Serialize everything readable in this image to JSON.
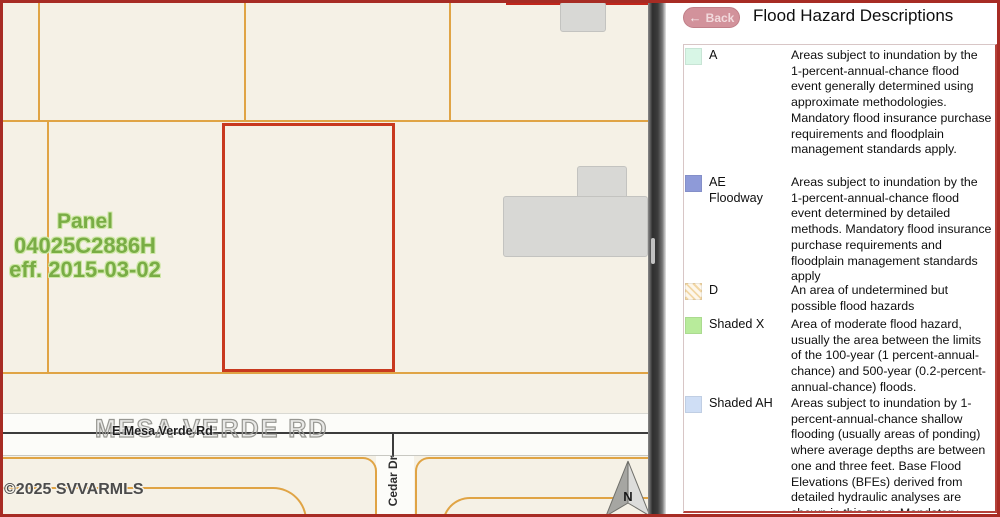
{
  "map": {
    "panel_label": {
      "line1": "Panel",
      "line2": "04025C2886H",
      "line3": "eff. 2015-03-02"
    },
    "roads": {
      "main_outline": "MESA VERDE RD",
      "main": "E Mesa Verde Rd",
      "cross": "Cedar Dr"
    },
    "copyright": "©2025 SVVARMLS",
    "north_label": "N",
    "colors": {
      "background": "#f5f1e6",
      "parcel_line": "#e0a445",
      "selected_parcel_outline": "#c8391f",
      "building_fill": "#d8d8d5",
      "panel_label_green": "#79ad45",
      "road_fill": "#fcfcf9"
    }
  },
  "panel": {
    "back_label": "Back",
    "back_arrow": "←",
    "title": "Flood Hazard Descriptions",
    "legend": [
      {
        "code": "A",
        "swatch": "solid",
        "color": "#d8f6e6",
        "description": "Areas subject to inundation by the 1-percent-annual-chance flood event generally determined using approximate methodologies. Mandatory flood insurance purchase requirements and floodplain management standards apply."
      },
      {
        "code": "AE\nFloodway",
        "swatch": "solid",
        "color": "#8e9ad8",
        "description": "Areas subject to inundation by the 1-percent-annual-chance flood event determined by detailed methods. Mandatory flood insurance purchase requirements and floodplain management standards apply"
      },
      {
        "code": "D",
        "swatch": "hatch",
        "color": "#f2d7a6",
        "description": "An area of undetermined but possible flood hazards"
      },
      {
        "code": "Shaded X",
        "swatch": "solid",
        "color": "#b8eb9b",
        "description": "Area of moderate flood hazard, usually the area between the limits of the 100-year (1 percent-annual-chance) and 500-year (0.2-percent-annual-chance) floods."
      },
      {
        "code": "Shaded AH",
        "swatch": "solid",
        "color": "#cfdef5",
        "description": "Areas subject to inundation by 1-percent-annual-chance shallow flooding (usually areas of ponding) where average depths are between one and three feet. Base Flood Elevations (BFEs) derived from detailed hydraulic analyses are shown in this zone. Mandatory"
      }
    ]
  }
}
